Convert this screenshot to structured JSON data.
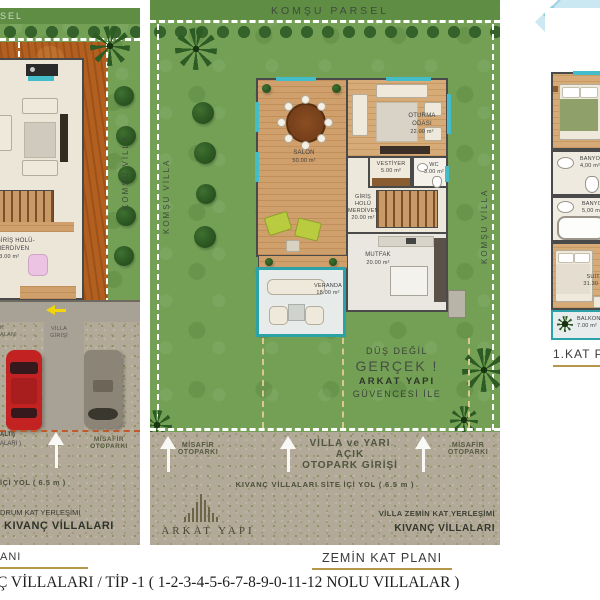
{
  "header": {
    "komsu_parsel": "KOMŞU PARSEL",
    "komsu_parsel_cut": "SEL"
  },
  "left_panel": {
    "komsu_villa": "KOMŞU VİLLA",
    "giris_holu": {
      "line1": "GİRİŞ HOLÜ-",
      "line2": "MERDİVEN",
      "area": "33.00 m²"
    },
    "villa_girisi": {
      "line1": "VİLLA",
      "line2": "GİRİŞİ"
    },
    "edge_fragment": {
      "line1": "K",
      "line2": "ALANI"
    },
    "alti_fragment": "ALTI)",
    "alari_fragment": "ALARI )",
    "misafir": {
      "line1": "MİSAFİR",
      "line2": "OTOPARKI"
    },
    "yol_fragment": "İÇİ YOL ( 6.5 m )",
    "yerlesim_fragment": "DRUM KAT YERLEŞİMİ",
    "brand": "KIVANÇ VİLLALARI",
    "title_fragment": "ANI"
  },
  "center_panel": {
    "komsu_villa_left": "KOMŞU VİLLA",
    "komsu_villa_right": "KOMŞU VİLLA",
    "rooms": {
      "salon": {
        "name": "SALON",
        "area": "50.00 m²"
      },
      "oturma": {
        "line1": "OTURMA",
        "line2": "ODASI",
        "area": "22.00 m²"
      },
      "vestiyer": {
        "name": "VESTİYER",
        "area": "5.00 m²"
      },
      "wc": {
        "name": "WC",
        "area": "3.00 m²"
      },
      "giris": {
        "line1": "GİRİŞ HOLÜ",
        "line2": "MERDİVEN",
        "area": "20.00 m²"
      },
      "mutfak": {
        "name": "MUTFAK",
        "area": "20.00 m²"
      },
      "veranda": {
        "name": "VERANDA",
        "area": "18.00 m²"
      }
    },
    "slogan": {
      "line1": "DÜŞ DEĞİL",
      "line2": "GERÇEK !",
      "line3": "ARKAT YAPI",
      "line4": "GÜVENCESİ İLE"
    },
    "road": {
      "misafir_left": {
        "line1": "MİSAFİR",
        "line2": "OTOPARKI"
      },
      "entrance": {
        "line1": "VİLLA ve YARI AÇIK",
        "line2": "OTOPARK GİRİŞİ"
      },
      "misafir_right": {
        "line1": "MİSAFİR",
        "line2": "OTOPARKI"
      },
      "street": "KIVANÇ VİLLALARI  SİTE İÇİ YOL ( 6.5 m )"
    },
    "logo_text": "ARKAT YAPI",
    "caption": {
      "line1": "VİLLA ZEMİN KAT YERLEŞİMİ",
      "line2": "KIVANÇ VİLLALARI"
    },
    "plan_title": "ZEMİN KAT PLANI"
  },
  "right_panel": {
    "banyo1": {
      "name": "BANYO",
      "area": "4,00 m²"
    },
    "banyo2": {
      "name": "BANYO",
      "area": "5,00 m²"
    },
    "suit": {
      "name": "SUİT -",
      "area": "31.30 m²"
    },
    "balkon": {
      "name": "BALKON",
      "area": "7.00 m²"
    },
    "plan_title": "1.KAT PLANI"
  },
  "footer": {
    "text": "Ç VİLLALARI / TİP -1 ( 1-2-3-4-5-6-7-8-9-0-11-12 NOLU VILLALAR )"
  }
}
